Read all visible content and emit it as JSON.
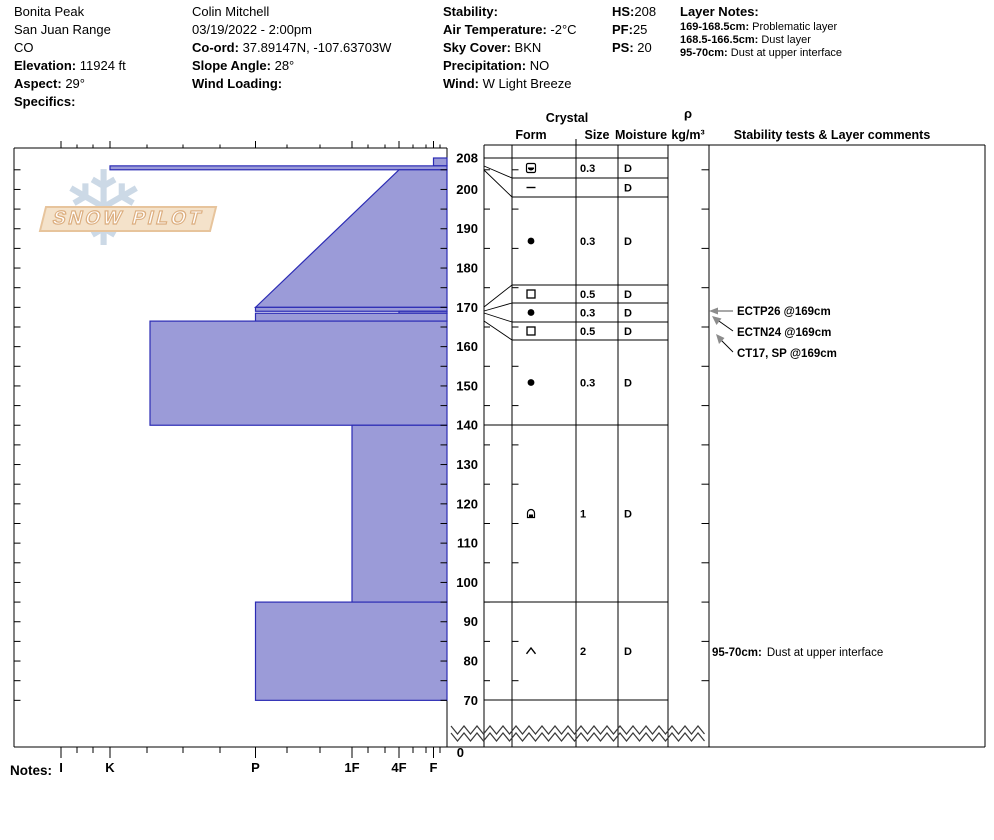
{
  "header": {
    "site": {
      "name": "Bonita Peak",
      "range": "San Juan Range",
      "state": "CO",
      "elevation_label": "Elevation:",
      "elevation": "11924 ft",
      "aspect_label": "Aspect:",
      "aspect": "29°",
      "specifics_label": "Specifics:"
    },
    "observer": {
      "name": "Colin Mitchell",
      "datetime": "03/19/2022 - 2:00pm",
      "coord_label": "Co-ord:",
      "coord": "37.89147N, -107.63703W",
      "slope_label": "Slope Angle:",
      "slope": "28°",
      "wind_loading_label": "Wind Loading:"
    },
    "conditions": {
      "stability_label": "Stability:",
      "air_temp_label": "Air Temperature:",
      "air_temp": "-2°C",
      "sky_label": "Sky Cover:",
      "sky": "BKN",
      "precip_label": "Precipitation:",
      "precip": "NO",
      "wind_label": "Wind:",
      "wind": "W Light Breeze"
    },
    "depth_summary": {
      "hs_label": "HS:",
      "hs": "208",
      "pf_label": "PF:",
      "pf": "25",
      "ps_label": "PS:",
      "ps": "20"
    },
    "layer_notes": {
      "title": "Layer Notes:",
      "notes": [
        {
          "range": "169-168.5cm:",
          "text": "Problematic layer"
        },
        {
          "range": "168.5-166.5cm:",
          "text": "Dust layer"
        },
        {
          "range": "95-70cm:",
          "text": "Dust at upper interface"
        }
      ]
    }
  },
  "logo": {
    "text": "SNOW PILOT",
    "snowflake_icon": "❄"
  },
  "table_headers": {
    "crystal": "Crystal",
    "form": "Form",
    "size": "Size",
    "moisture": "Moisture",
    "rho": "ρ",
    "rho_units": "kg/m³",
    "stability": "Stability tests & Layer comments"
  },
  "stability_tests": [
    "ECTP26 @169cm",
    "ECTN24 @169cm",
    "CT17, SP @169cm"
  ],
  "layer_comment": {
    "range": "95-70cm:",
    "text": "Dust at upper interface"
  },
  "notes_label": "Notes:",
  "chart_data": {
    "type": "area",
    "title": "Snow profile hardness chart",
    "xlabel": "Hand hardness",
    "ylabel": "Depth (cm)",
    "x_categories": [
      "I",
      "K",
      "P",
      "1F",
      "4F",
      "F"
    ],
    "ylim": [
      0,
      208
    ],
    "total_height_cm": 208,
    "depth_tick_labels": [
      208,
      200,
      190,
      180,
      170,
      160,
      150,
      140,
      130,
      120,
      110,
      100,
      90,
      80,
      70
    ],
    "zero_label": "0",
    "bar_fill": "#9b9bd8",
    "bar_stroke": "#2b2bb4",
    "layers": [
      {
        "top": 208,
        "bottom": 206,
        "hardness": "F",
        "form": "rounding-facets",
        "size": "0.3",
        "moisture": "D"
      },
      {
        "top": 206,
        "bottom": 205,
        "hardness": "K",
        "form": "ice-dash",
        "size": "",
        "moisture": "D"
      },
      {
        "top": 205,
        "bottom": 170,
        "hardness_top": "4F",
        "hardness_bottom": "P",
        "form": "rounded-grains",
        "size": "0.3",
        "moisture": "D"
      },
      {
        "top": 170,
        "bottom": 169,
        "hardness": "P",
        "form": "facets",
        "size": "0.5",
        "moisture": "D"
      },
      {
        "top": 169,
        "bottom": 168.5,
        "hardness": "4F",
        "form": "rounded-grains",
        "size": "0.3",
        "moisture": "D"
      },
      {
        "top": 168.5,
        "bottom": 166.5,
        "hardness": "P",
        "form": "facets",
        "size": "0.5",
        "moisture": "D"
      },
      {
        "top": 166.5,
        "bottom": 140,
        "hardness": "P+",
        "form": "rounded-grains",
        "size": "0.3",
        "moisture": "D"
      },
      {
        "top": 140,
        "bottom": 95,
        "hardness": "1F",
        "form": "rounded-facets-arch",
        "size": "1",
        "moisture": "D"
      },
      {
        "top": 95,
        "bottom": 70,
        "hardness": "P",
        "form": "depth-hoar",
        "size": "2",
        "moisture": "D"
      }
    ]
  }
}
